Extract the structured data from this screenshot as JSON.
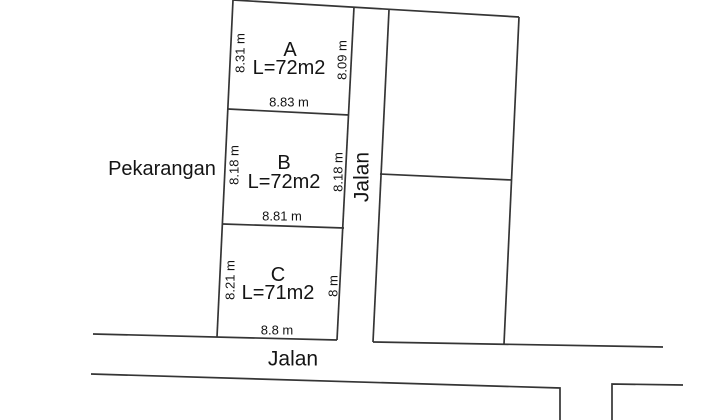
{
  "theme": {
    "background": "#ffffff",
    "line_color": "#353535",
    "text_color": "#141414"
  },
  "zone_label_left": "Pekarangan",
  "roads": {
    "vertical_label": "Jalan",
    "bottom_label": "Jalan"
  },
  "plots": [
    {
      "name": "A",
      "area": "L=72m2",
      "side_left": "8.31 m",
      "side_right": "8.09 m",
      "side_bottom": "8.83 m"
    },
    {
      "name": "B",
      "area": "L=72m2",
      "side_left": "8.18 m",
      "side_right": "8.18 m",
      "side_bottom": "8.81 m"
    },
    {
      "name": "C",
      "area": "L=71m2",
      "side_left": "8.21 m",
      "side_right": "8 m",
      "side_bottom": "8.8 m"
    }
  ]
}
